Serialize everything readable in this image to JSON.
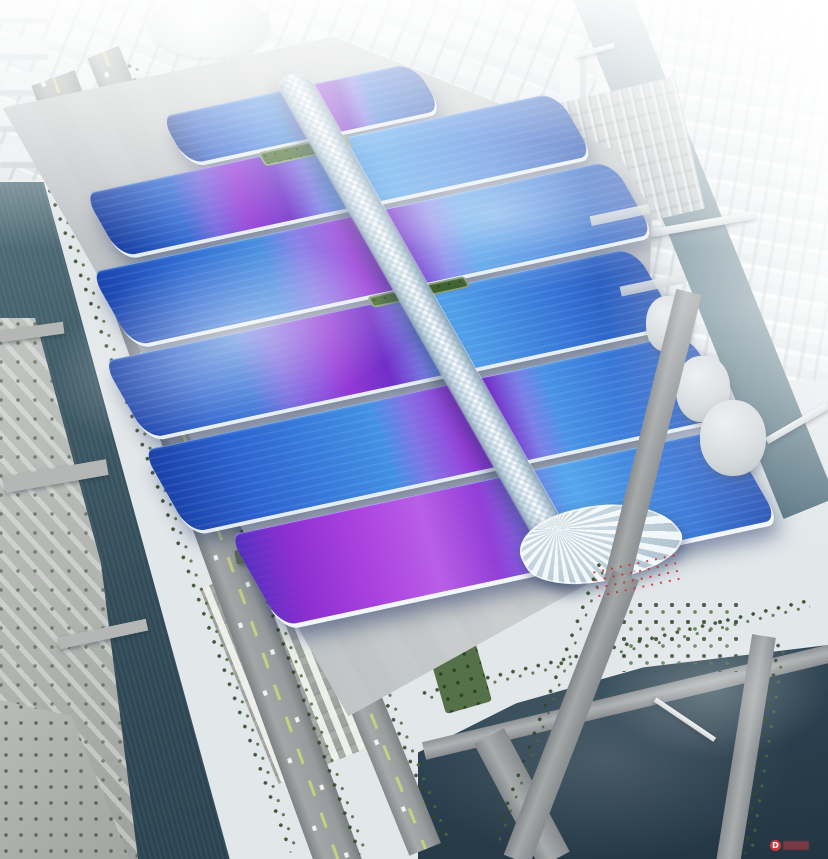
{
  "scene": {
    "subject": "Aerial architectural rendering of a riverside exhibition center: six rows of wavy exhibition-hall roofs in blue with violet sweeps, crossed by a winding white central canopy spine ending in a shell-shaped entrance canopy, surrounded by grey aprons, parking lots, tree-lined roads, canals and a hazy white city skyline",
    "hall_rows": 6,
    "palette": {
      "roof_blue_deep": "#1a44ae",
      "roof_blue_bright": "#55a4ec",
      "roof_violet": "#9e30d6",
      "roof_magenta": "#c65ce8",
      "spine_white": "#f2f8fb",
      "water_dark": "#2c4250",
      "water_canal": "#5d7e8a",
      "road_grey": "#9aa0a0",
      "apron_grey": "#c3c6c7",
      "tree_green": "#46623a",
      "plaza_grey": "#d2d5d4",
      "fog_white": "#ffffff",
      "accent_red": "#cc3640"
    }
  },
  "watermark": {
    "logo_letter": "D"
  }
}
